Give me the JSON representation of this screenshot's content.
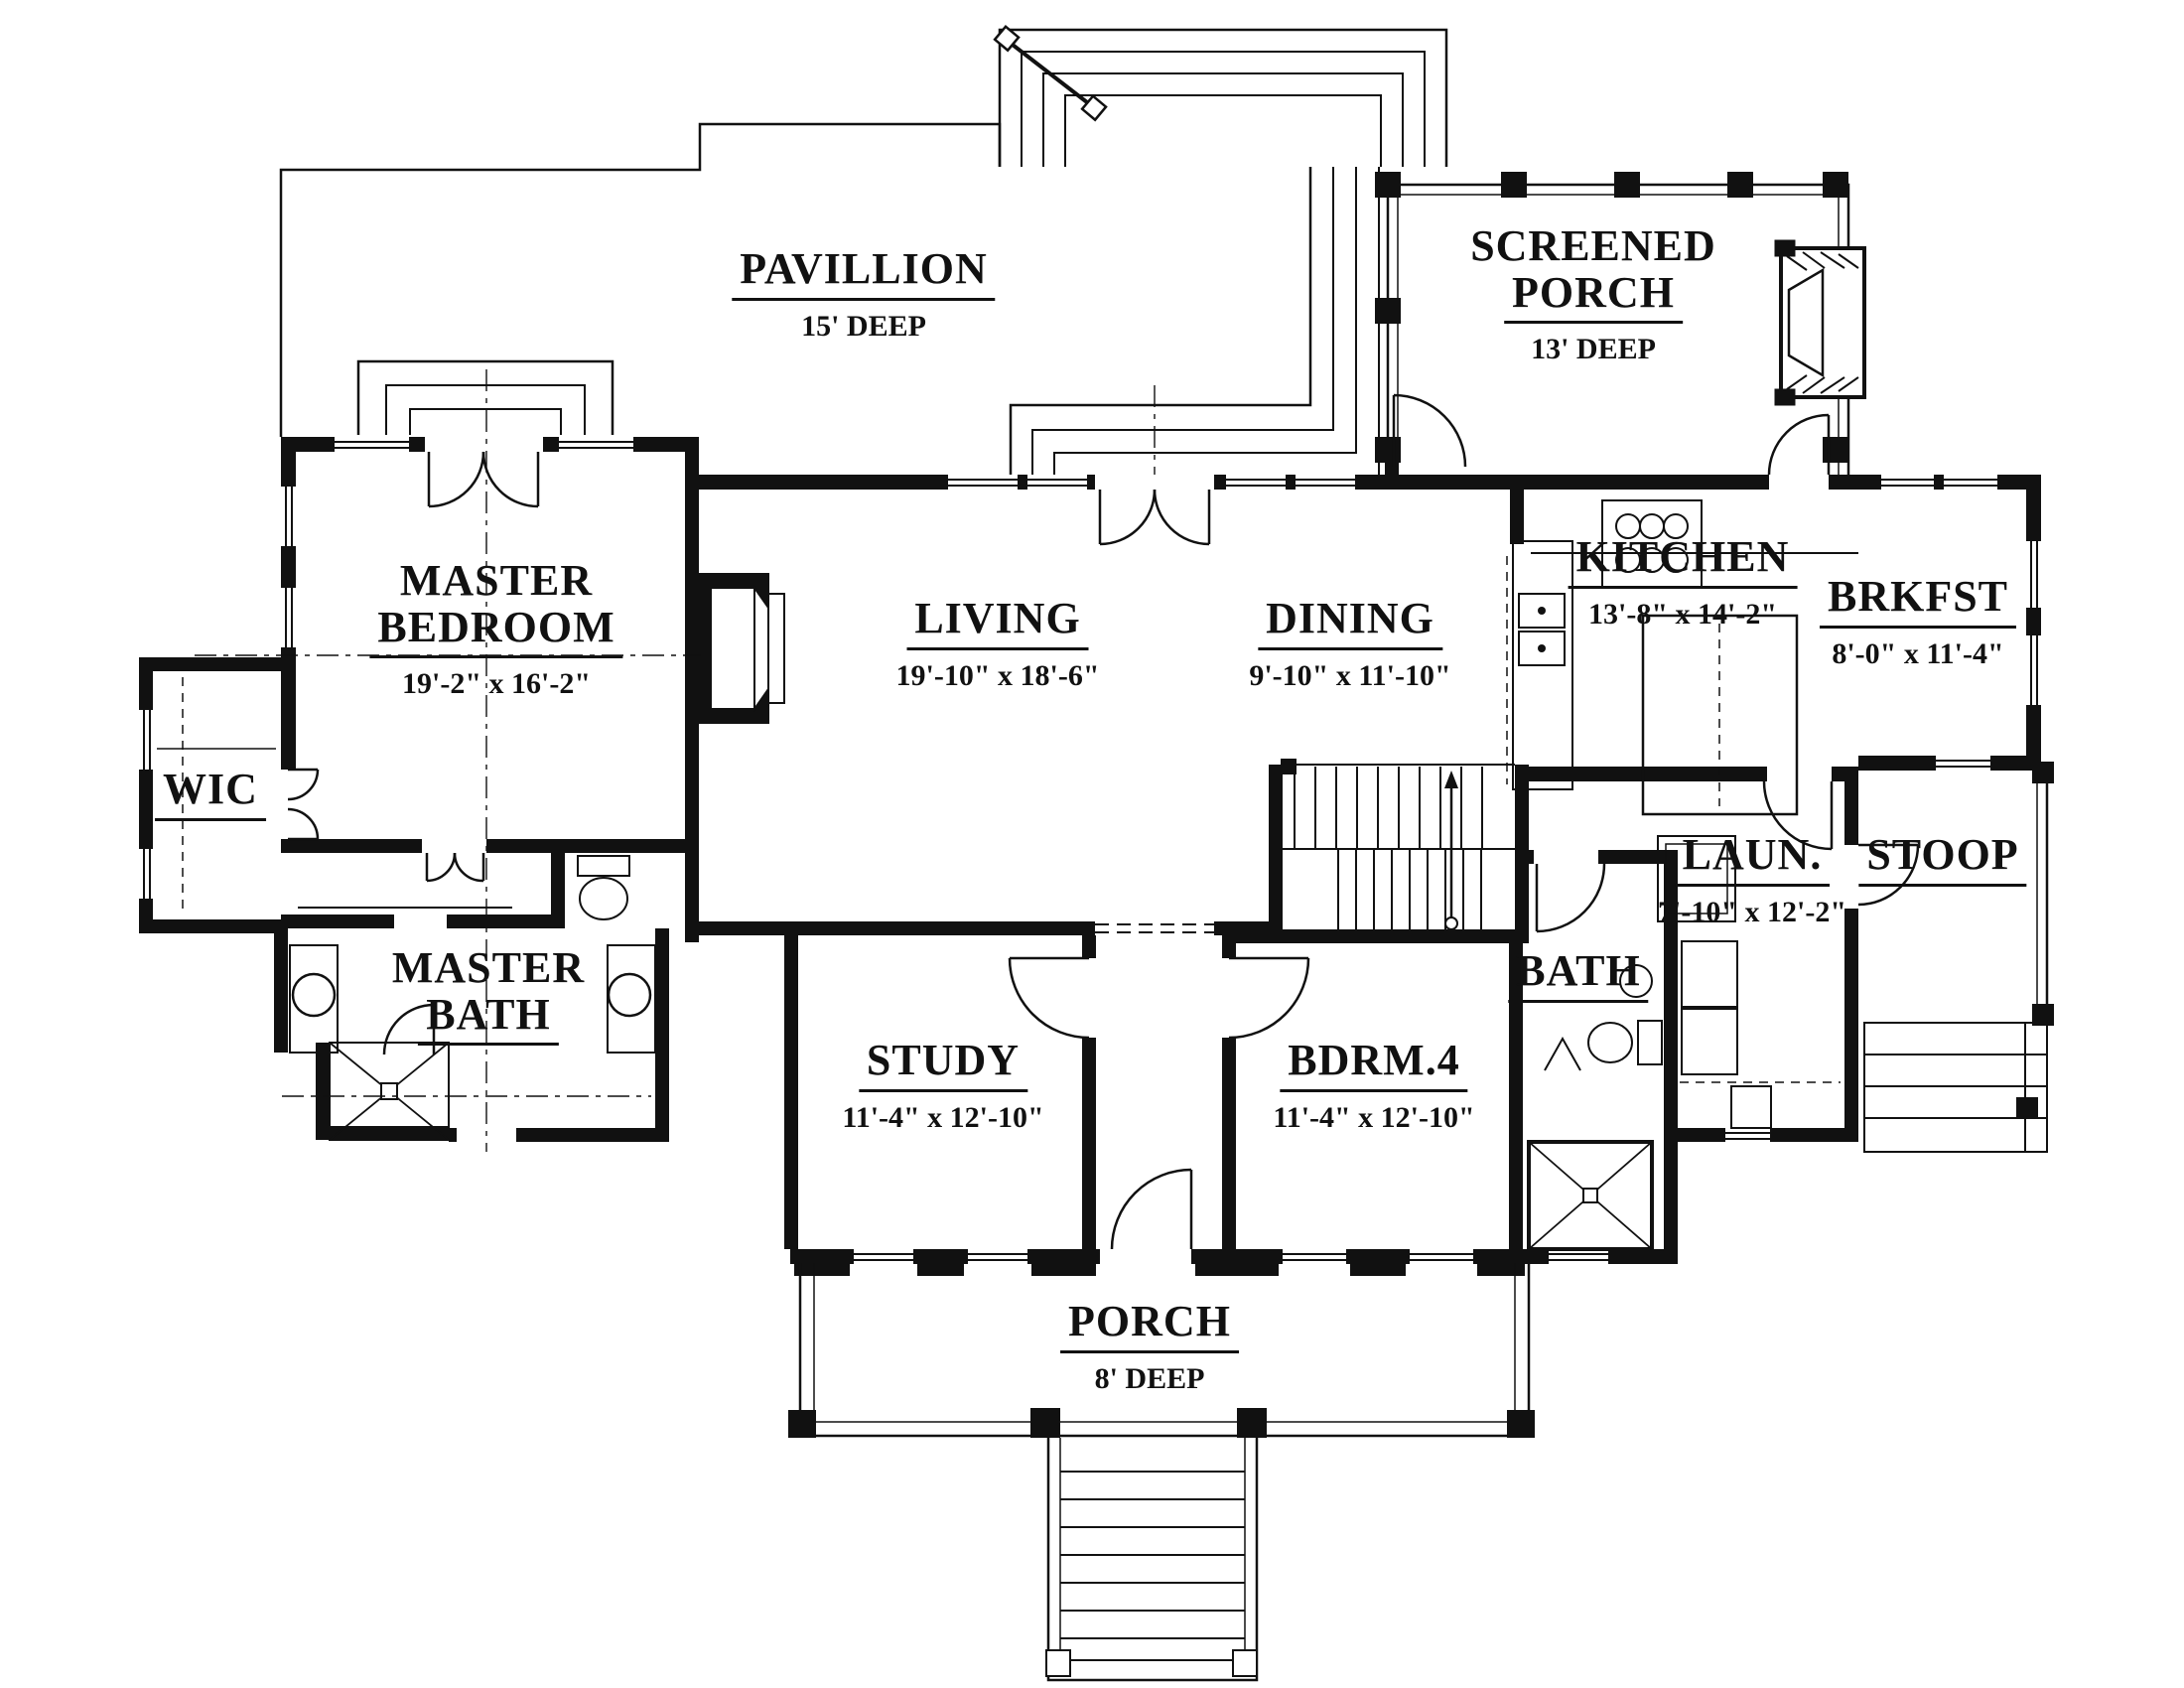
{
  "drawing_title": "First Floor Plan",
  "colors": {
    "ink": "#111111",
    "paper": "#ffffff"
  },
  "rooms": {
    "pavillion": {
      "name": "PAVILLION",
      "dims": "15' DEEP"
    },
    "screened_porch": {
      "name1": "SCREENED",
      "name2": "PORCH",
      "dims": "13' DEEP"
    },
    "master_bedroom": {
      "name1": "MASTER",
      "name2": "BEDROOM",
      "dims": "19'-2\" x 16'-2\""
    },
    "living": {
      "name": "LIVING",
      "dims": "19'-10\" x 18'-6\""
    },
    "dining": {
      "name": "DINING",
      "dims": "9'-10\" x 11'-10\""
    },
    "kitchen": {
      "name": "KITCHEN",
      "dims": "13'-8\" x 14'-2\""
    },
    "brkfst": {
      "name": "BRKFST",
      "dims": "8'-0\" x 11'-4\""
    },
    "wic": {
      "name": "WIC"
    },
    "master_bath": {
      "name1": "MASTER",
      "name2": "BATH"
    },
    "study": {
      "name": "STUDY",
      "dims": "11'-4\" x 12'-10\""
    },
    "bdrm4": {
      "name": "BDRM.4",
      "dims": "11'-4\" x 12'-10\""
    },
    "bath": {
      "name": "BATH"
    },
    "laundry": {
      "name": "LAUN.",
      "dims": "7'-10\" x 12'-2\""
    },
    "stoop": {
      "name": "STOOP"
    },
    "porch": {
      "name": "PORCH",
      "dims": "8' DEEP"
    }
  }
}
